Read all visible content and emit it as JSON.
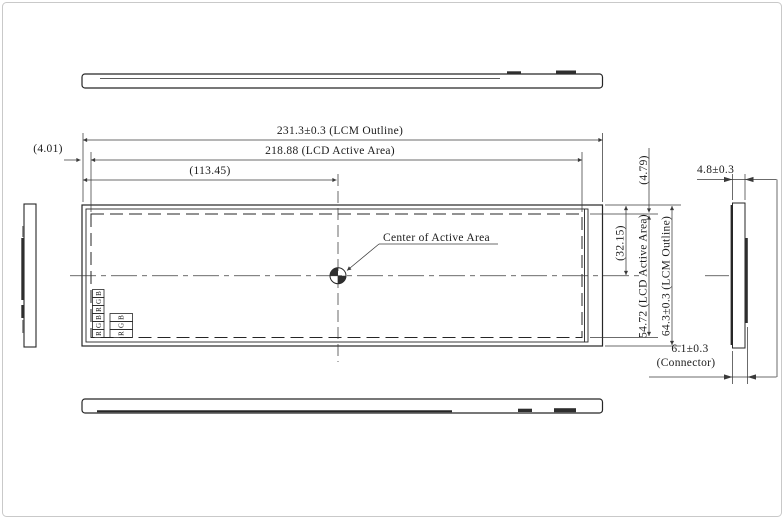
{
  "drawing": {
    "labels": {
      "center": "Center of Active Area"
    },
    "dims": {
      "lcm_width": "231.3±0.3 (LCM Outline)",
      "active_width": "218.88 (LCD Active Area)",
      "center_offset": "(113.45)",
      "left_margin": "(4.01)",
      "top_margin": "(4.79)",
      "half_height": "(32.15)",
      "active_height": "54.72 (LCD Active Area)",
      "lcm_height": "64.3±0.3 (LCM Outline)",
      "thickness": "4.8±0.3",
      "connector": "6.1±0.3",
      "connector_label": "(Connector)"
    },
    "subpixels": {
      "left": [
        "B",
        "G",
        "R",
        "B",
        "G",
        "R"
      ],
      "right": [
        "B",
        "G",
        "R"
      ]
    },
    "colors": {
      "line": "#262626",
      "dim_line": "#3a3a3a",
      "frame": "#c9c9c9",
      "background": "#ffffff"
    }
  }
}
